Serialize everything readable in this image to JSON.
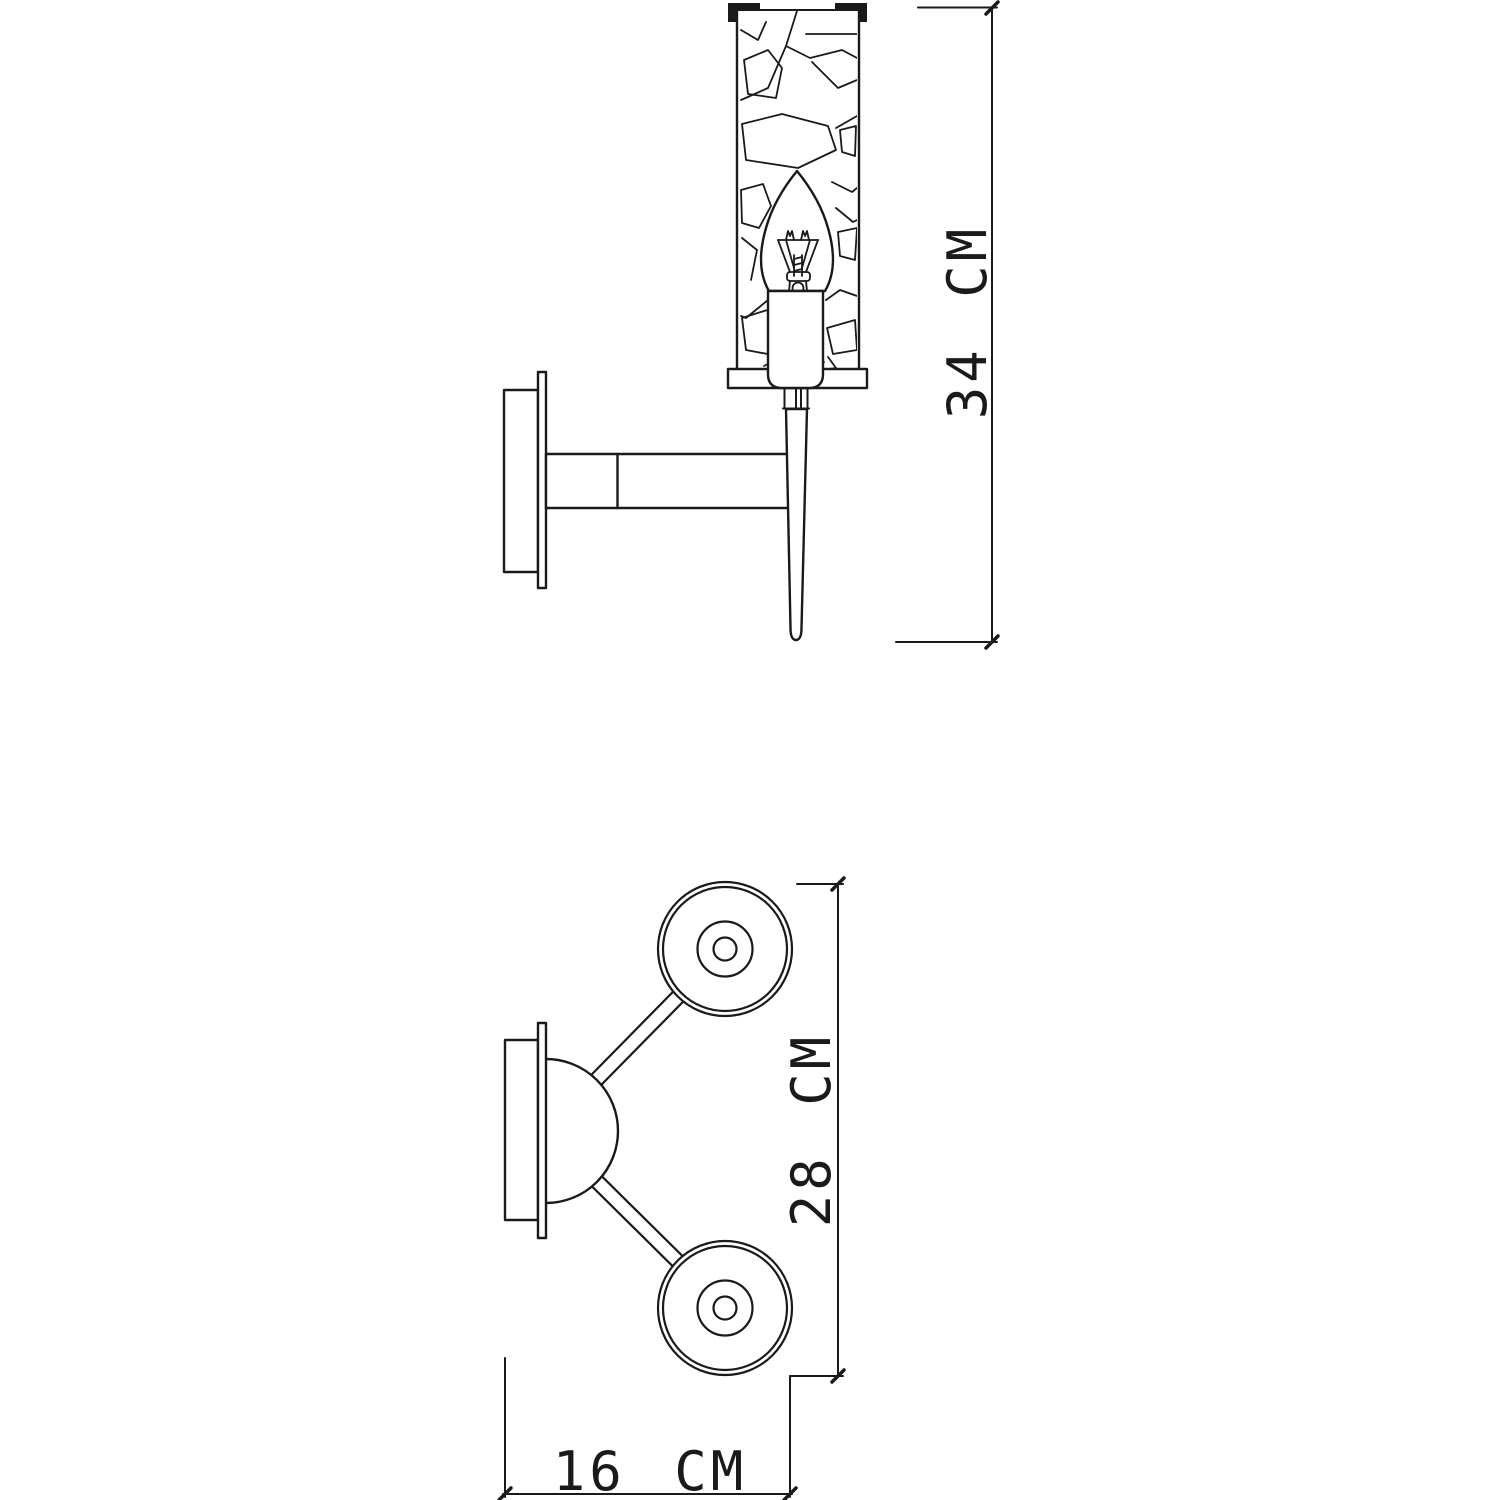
{
  "colors": {
    "background": "#ffffff",
    "line": "#1a1a1a"
  },
  "dimensions": {
    "height": {
      "value": "34",
      "unit": "CM",
      "label": "34 CM"
    },
    "span": {
      "value": "28",
      "unit": "CM",
      "label": "28 CM"
    },
    "depth": {
      "value": "16",
      "unit": "CM",
      "label": "16 CM"
    }
  }
}
